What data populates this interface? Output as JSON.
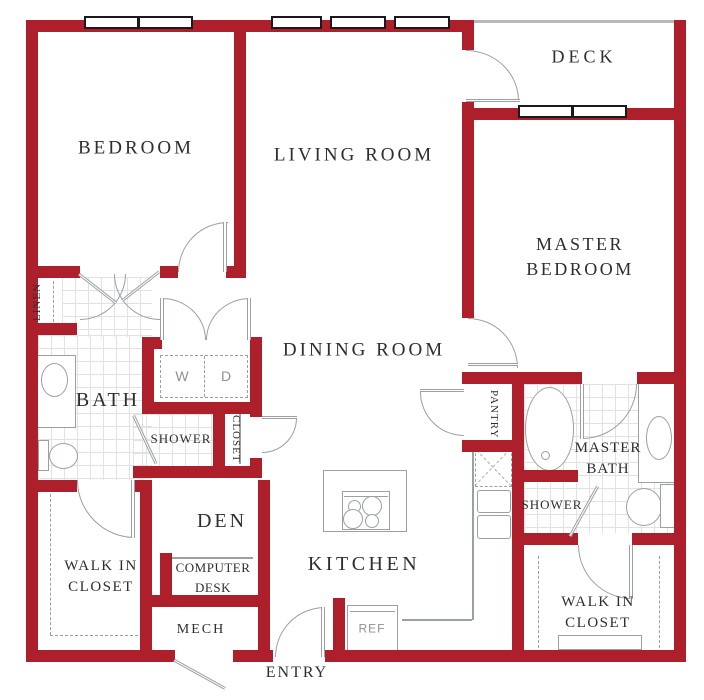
{
  "colors": {
    "wall": "#ae1f2c",
    "line": "#9aa0a4",
    "tile": "#e2e2e2",
    "text": "#2e2e2e",
    "muted": "#8f9094",
    "win": "#1a1a1a"
  },
  "rooms": {
    "bedroom": "BEDROOM",
    "living_room": "LIVING ROOM",
    "deck": "DECK",
    "master_bedroom": "MASTER BEDROOM",
    "dining_room": "DINING ROOM",
    "kitchen": "KITCHEN",
    "den": "DEN",
    "bath": "BATH",
    "master_bath": "MASTER BATH",
    "entry": "ENTRY"
  },
  "closets": {
    "linen": "LINEN",
    "hall_closet": "CLOSET",
    "pantry": "PANTRY",
    "walk_in_closet": "WALK IN CLOSET",
    "master_walk_in_closet": "WALK IN CLOSET"
  },
  "fixtures": {
    "shower": "SHOWER",
    "master_shower": "SHOWER",
    "computer_desk": "COMPUTER DESK",
    "mech": "MECH",
    "washer": "W",
    "dryer": "D",
    "refrigerator": "REF"
  }
}
